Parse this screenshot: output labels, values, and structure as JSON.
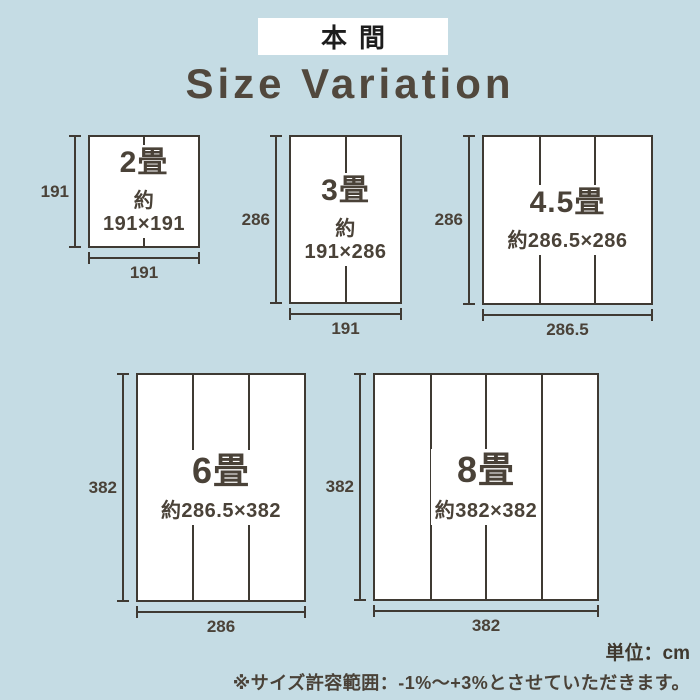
{
  "header": {
    "badge": "本間",
    "title": "Size Variation"
  },
  "sizes": [
    {
      "name": "2畳",
      "dims": "約191×191",
      "height_label": "191",
      "width_label": "191",
      "panels": 2
    },
    {
      "name": "3畳",
      "dims": "約191×286",
      "height_label": "286",
      "width_label": "191",
      "panels": 2
    },
    {
      "name": "4.5畳",
      "dims": "約286.5×286",
      "height_label": "286",
      "width_label": "286.5",
      "panels": 3
    },
    {
      "name": "6畳",
      "dims": "約286.5×382",
      "height_label": "382",
      "width_label": "286",
      "panels": 3
    },
    {
      "name": "8畳",
      "dims": "約382×382",
      "height_label": "382",
      "width_label": "382",
      "panels": 4
    }
  ],
  "footer": {
    "unit_label": "単位：cm",
    "tolerance_note": "※サイズ許容範囲：-1%〜+3%とさせていただきます。"
  },
  "colors": {
    "background": "#c5dce4",
    "line": "#3f3a33",
    "text": "#4a4238",
    "badge_bg": "#ffffff",
    "badge_text": "#1d1d1d",
    "title_text": "#51483d",
    "mat_bg": "#ffffff"
  }
}
